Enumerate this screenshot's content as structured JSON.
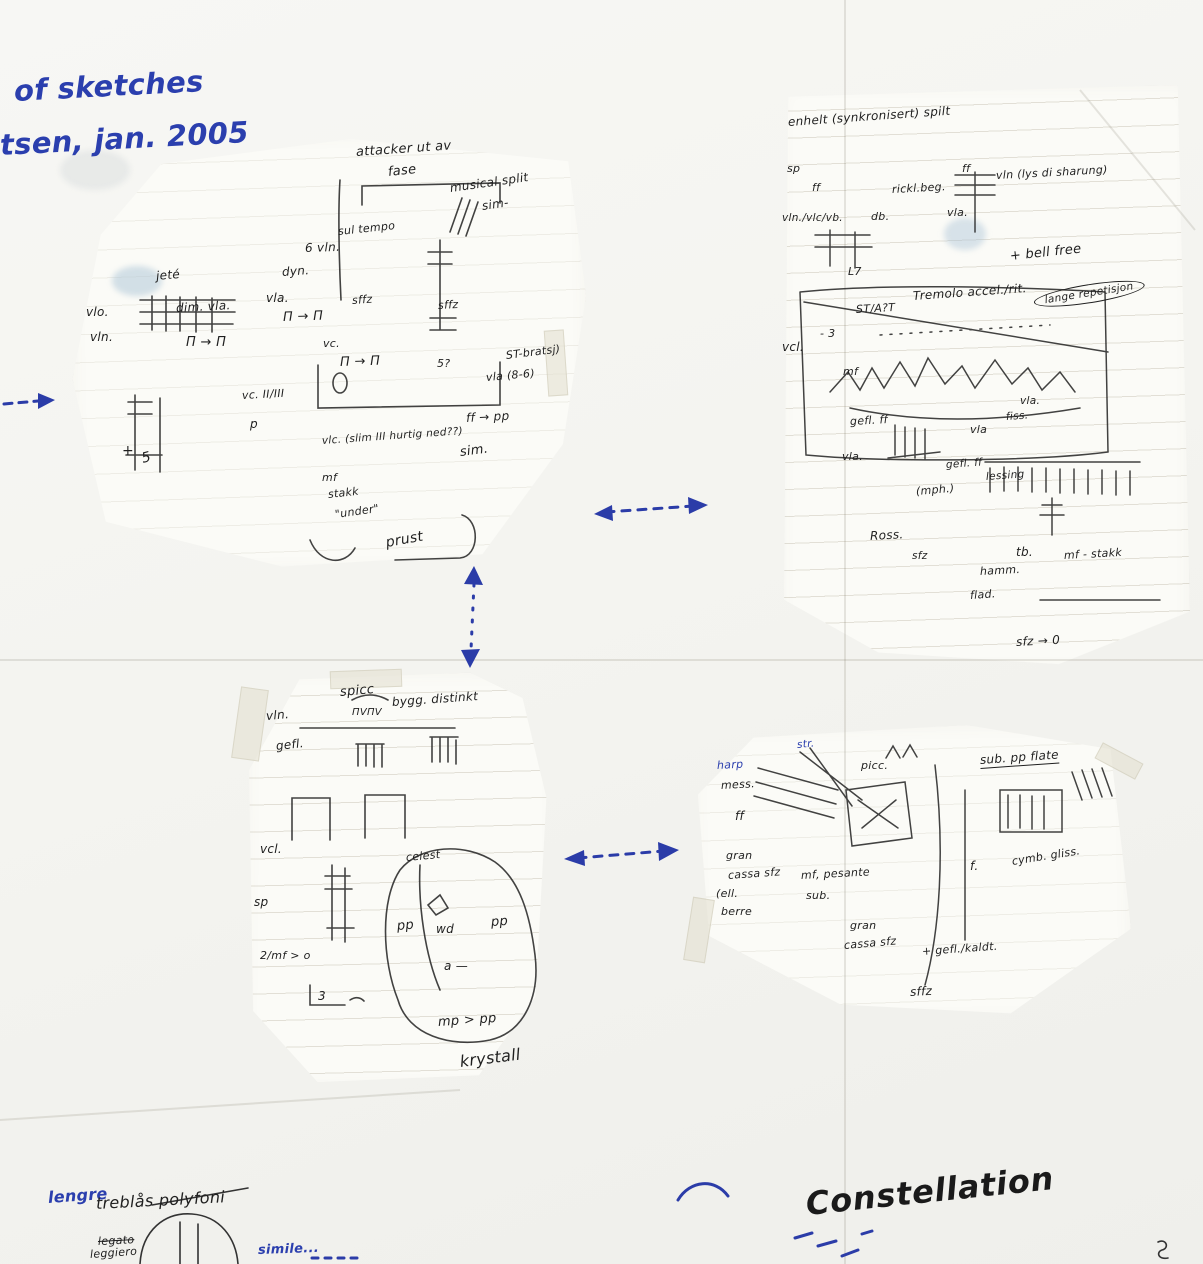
{
  "colors": {
    "ink": "#1f1f1f",
    "blue": "#2b3fae",
    "marker": "#1a1a1a",
    "paper": "#f6f6f3"
  },
  "labels": [
    {
      "n": "note-of-sketches",
      "t": "of sketches",
      "x": 14,
      "y": 76,
      "s": 29,
      "c": "blue",
      "r": -3,
      "w": 600
    },
    {
      "n": "note-date",
      "t": "tsen, jan. 2005",
      "x": 0,
      "y": 130,
      "s": 29,
      "c": "blue",
      "r": -3,
      "w": 600
    },
    {
      "t": "attacker ut av",
      "x": 356,
      "y": 146,
      "s": 13,
      "r": -4
    },
    {
      "t": "fase",
      "x": 388,
      "y": 166,
      "s": 13,
      "r": -6
    },
    {
      "t": "musical split",
      "x": 450,
      "y": 182,
      "s": 12,
      "r": -8
    },
    {
      "t": "sim-",
      "x": 482,
      "y": 200,
      "s": 12,
      "r": -8
    },
    {
      "t": "jeté",
      "x": 156,
      "y": 270,
      "s": 12,
      "r": -5
    },
    {
      "t": "dyn.",
      "x": 282,
      "y": 266,
      "s": 12,
      "r": -4
    },
    {
      "t": "sul tempo",
      "x": 338,
      "y": 226,
      "s": 11,
      "r": -6
    },
    {
      "t": "6 vln.",
      "x": 305,
      "y": 242,
      "s": 12,
      "r": -2
    },
    {
      "t": "vlo.",
      "x": 86,
      "y": 306,
      "s": 12
    },
    {
      "t": "vln.",
      "x": 90,
      "y": 331,
      "s": 12
    },
    {
      "t": "dim. vla.",
      "x": 176,
      "y": 302,
      "s": 12,
      "r": -3
    },
    {
      "t": "Π → Π",
      "x": 186,
      "y": 336,
      "s": 13
    },
    {
      "t": "vla.",
      "x": 266,
      "y": 292,
      "s": 12
    },
    {
      "t": "Π → Π",
      "x": 283,
      "y": 311,
      "s": 13,
      "r": -2
    },
    {
      "t": "sffz",
      "x": 352,
      "y": 295,
      "s": 11,
      "r": -4
    },
    {
      "t": "sffz",
      "x": 438,
      "y": 300,
      "s": 11,
      "r": -3
    },
    {
      "t": "vc.",
      "x": 323,
      "y": 338,
      "s": 11
    },
    {
      "t": "Π → Π",
      "x": 340,
      "y": 356,
      "s": 13,
      "r": -2
    },
    {
      "t": "5?",
      "x": 437,
      "y": 358,
      "s": 11
    },
    {
      "t": "ST-bratsj)",
      "x": 506,
      "y": 350,
      "s": 11,
      "r": -7
    },
    {
      "t": "vla (8-6)",
      "x": 486,
      "y": 372,
      "s": 11,
      "r": -5
    },
    {
      "t": "vc. II/III",
      "x": 242,
      "y": 390,
      "s": 11,
      "r": -3
    },
    {
      "t": "p",
      "x": 250,
      "y": 418,
      "s": 12
    },
    {
      "t": "vlc. (slim III hurtig ned??)",
      "x": 322,
      "y": 436,
      "s": 10.5,
      "r": -4
    },
    {
      "t": "sim.",
      "x": 460,
      "y": 446,
      "s": 13,
      "r": -7
    },
    {
      "t": "ff → pp",
      "x": 466,
      "y": 412,
      "s": 12,
      "r": -3
    },
    {
      "t": "mf",
      "x": 322,
      "y": 472,
      "s": 11
    },
    {
      "t": "stakk",
      "x": 328,
      "y": 489,
      "s": 11,
      "r": -6
    },
    {
      "t": "\"under\"",
      "x": 335,
      "y": 509,
      "s": 11,
      "r": -8
    },
    {
      "t": "prust",
      "x": 386,
      "y": 536,
      "s": 14,
      "r": -10
    },
    {
      "t": "+",
      "x": 122,
      "y": 444,
      "s": 14
    },
    {
      "t": "5",
      "x": 142,
      "y": 452,
      "s": 14,
      "r": -14
    },
    {
      "t": "enhelt (synkronisert) spilt",
      "x": 788,
      "y": 116,
      "s": 12,
      "r": -4
    },
    {
      "t": "sp",
      "x": 787,
      "y": 163,
      "s": 11
    },
    {
      "t": "ff",
      "x": 812,
      "y": 182,
      "s": 11
    },
    {
      "t": "rickl.beg.",
      "x": 892,
      "y": 184,
      "s": 11,
      "r": -3
    },
    {
      "t": "ff",
      "x": 962,
      "y": 163,
      "s": 11
    },
    {
      "t": "vln (lys di sharung)",
      "x": 996,
      "y": 170,
      "s": 11,
      "r": -3
    },
    {
      "t": "vln./vlc/vb.",
      "x": 782,
      "y": 213,
      "s": 10.5
    },
    {
      "t": "db.",
      "x": 871,
      "y": 211,
      "s": 11
    },
    {
      "t": "vla.",
      "x": 947,
      "y": 207,
      "s": 11
    },
    {
      "t": "L7",
      "x": 848,
      "y": 266,
      "s": 11
    },
    {
      "t": "+ bell free",
      "x": 1010,
      "y": 250,
      "s": 13,
      "r": -6
    },
    {
      "t": "Tremolo accel./rit.",
      "x": 913,
      "y": 290,
      "s": 12,
      "r": -4
    },
    {
      "t": "lange repetisjon",
      "x": 1034,
      "y": 293,
      "s": 10.5,
      "r": -9,
      "cls": "circled"
    },
    {
      "t": "ST/A?T",
      "x": 856,
      "y": 304,
      "s": 11,
      "r": -3
    },
    {
      "t": "- 3",
      "x": 820,
      "y": 328,
      "s": 11
    },
    {
      "t": "vcl.",
      "x": 782,
      "y": 341,
      "s": 12
    },
    {
      "t": "mf",
      "x": 843,
      "y": 366,
      "s": 11
    },
    {
      "t": "vla.",
      "x": 1020,
      "y": 396,
      "s": 10.5
    },
    {
      "t": "fiss.",
      "x": 1006,
      "y": 412,
      "s": 10.5,
      "r": -4
    },
    {
      "t": "vla",
      "x": 970,
      "y": 424,
      "s": 11
    },
    {
      "t": "gefl. ff",
      "x": 850,
      "y": 416,
      "s": 11,
      "r": -3
    },
    {
      "t": "vla.",
      "x": 842,
      "y": 451,
      "s": 11
    },
    {
      "t": "gefl. ff",
      "x": 946,
      "y": 460,
      "s": 10.5,
      "r": -4
    },
    {
      "t": "lessing",
      "x": 986,
      "y": 472,
      "s": 10.5,
      "r": -4
    },
    {
      "t": "(mph.)",
      "x": 916,
      "y": 486,
      "s": 11,
      "r": -5
    },
    {
      "t": "Ross.",
      "x": 870,
      "y": 530,
      "s": 12,
      "r": -3
    },
    {
      "t": "sfz",
      "x": 912,
      "y": 551,
      "s": 10.5
    },
    {
      "t": "tb.",
      "x": 1016,
      "y": 546,
      "s": 12
    },
    {
      "t": "mf - stakk",
      "x": 1064,
      "y": 550,
      "s": 11,
      "r": -3
    },
    {
      "t": "hamm.",
      "x": 980,
      "y": 566,
      "s": 11,
      "r": -3
    },
    {
      "t": "flad.",
      "x": 970,
      "y": 590,
      "s": 11,
      "r": -4
    },
    {
      "t": "sfz → 0",
      "x": 1016,
      "y": 636,
      "s": 12,
      "r": -3
    },
    {
      "t": "spicc",
      "x": 340,
      "y": 686,
      "s": 13,
      "r": -5
    },
    {
      "t": "ΠVΠV",
      "x": 352,
      "y": 708,
      "s": 10
    },
    {
      "t": "bygg. distinkt",
      "x": 392,
      "y": 696,
      "s": 12,
      "r": -4
    },
    {
      "t": "vln.",
      "x": 266,
      "y": 710,
      "s": 12,
      "r": -5
    },
    {
      "t": "gefl.",
      "x": 276,
      "y": 740,
      "s": 12,
      "r": -6
    },
    {
      "t": "vcl.",
      "x": 260,
      "y": 843,
      "s": 12
    },
    {
      "t": "sp",
      "x": 254,
      "y": 896,
      "s": 12
    },
    {
      "t": "celest",
      "x": 406,
      "y": 852,
      "s": 11,
      "r": -5
    },
    {
      "t": "pp",
      "x": 397,
      "y": 920,
      "s": 13,
      "r": -5
    },
    {
      "t": "wd",
      "x": 436,
      "y": 923,
      "s": 12
    },
    {
      "t": "pp",
      "x": 491,
      "y": 916,
      "s": 13,
      "r": -4
    },
    {
      "t": "a —",
      "x": 444,
      "y": 960,
      "s": 12
    },
    {
      "t": "2/mf > o",
      "x": 260,
      "y": 950,
      "s": 11
    },
    {
      "t": "3",
      "x": 318,
      "y": 990,
      "s": 12
    },
    {
      "t": "mp > pp",
      "x": 438,
      "y": 1016,
      "s": 13,
      "r": -4
    },
    {
      "t": "krystall",
      "x": 460,
      "y": 1054,
      "s": 16,
      "r": -7
    },
    {
      "t": "str.",
      "x": 797,
      "y": 740,
      "s": 10.5,
      "c": "blue",
      "r": -5
    },
    {
      "t": "harp",
      "x": 717,
      "y": 760,
      "s": 11,
      "c": "blue",
      "r": -3
    },
    {
      "t": "mess.",
      "x": 721,
      "y": 780,
      "s": 11,
      "r": -3
    },
    {
      "t": "picc.",
      "x": 861,
      "y": 760,
      "s": 11
    },
    {
      "t": "sub. pp flate",
      "x": 980,
      "y": 754,
      "s": 12,
      "r": -4,
      "cls": "underline"
    },
    {
      "t": "ff",
      "x": 735,
      "y": 810,
      "s": 12
    },
    {
      "t": "gran",
      "x": 726,
      "y": 850,
      "s": 11
    },
    {
      "t": "cassa sfz",
      "x": 728,
      "y": 870,
      "s": 11,
      "r": -4
    },
    {
      "t": "(ell.",
      "x": 716,
      "y": 888,
      "s": 11
    },
    {
      "t": "berre",
      "x": 721,
      "y": 906,
      "s": 11
    },
    {
      "t": "mf, pesante",
      "x": 801,
      "y": 870,
      "s": 11,
      "r": -3
    },
    {
      "t": "sub.",
      "x": 806,
      "y": 890,
      "s": 11
    },
    {
      "t": "gran",
      "x": 850,
      "y": 920,
      "s": 11
    },
    {
      "t": "cassa sfz",
      "x": 844,
      "y": 940,
      "s": 11,
      "r": -5
    },
    {
      "t": "f.",
      "x": 970,
      "y": 860,
      "s": 12
    },
    {
      "t": "cymb. gliss.",
      "x": 1012,
      "y": 856,
      "s": 11,
      "r": -9
    },
    {
      "t": "+ gefl./kaldt.",
      "x": 922,
      "y": 946,
      "s": 11,
      "r": -4
    },
    {
      "t": "sffz",
      "x": 910,
      "y": 986,
      "s": 12,
      "r": -3
    },
    {
      "n": "note-lengre",
      "t": "lengre",
      "x": 48,
      "y": 1190,
      "s": 16,
      "c": "blue",
      "r": -4,
      "w": 600
    },
    {
      "t": "treblås polyfoni",
      "x": 96,
      "y": 1196,
      "s": 16,
      "r": -3
    },
    {
      "t": "legato",
      "x": 98,
      "y": 1236,
      "s": 11,
      "r": -3,
      "cls": "struck"
    },
    {
      "t": "leggiero",
      "x": 90,
      "y": 1249,
      "s": 11,
      "r": -4
    },
    {
      "n": "note-simile",
      "t": "simile...",
      "x": 258,
      "y": 1244,
      "s": 13,
      "c": "blue",
      "r": -2,
      "w": 600
    },
    {
      "n": "title-constellation",
      "t": "Constellation",
      "x": 806,
      "y": 1188,
      "s": 32,
      "c": "marker",
      "r": -6,
      "cls": "bold"
    }
  ]
}
